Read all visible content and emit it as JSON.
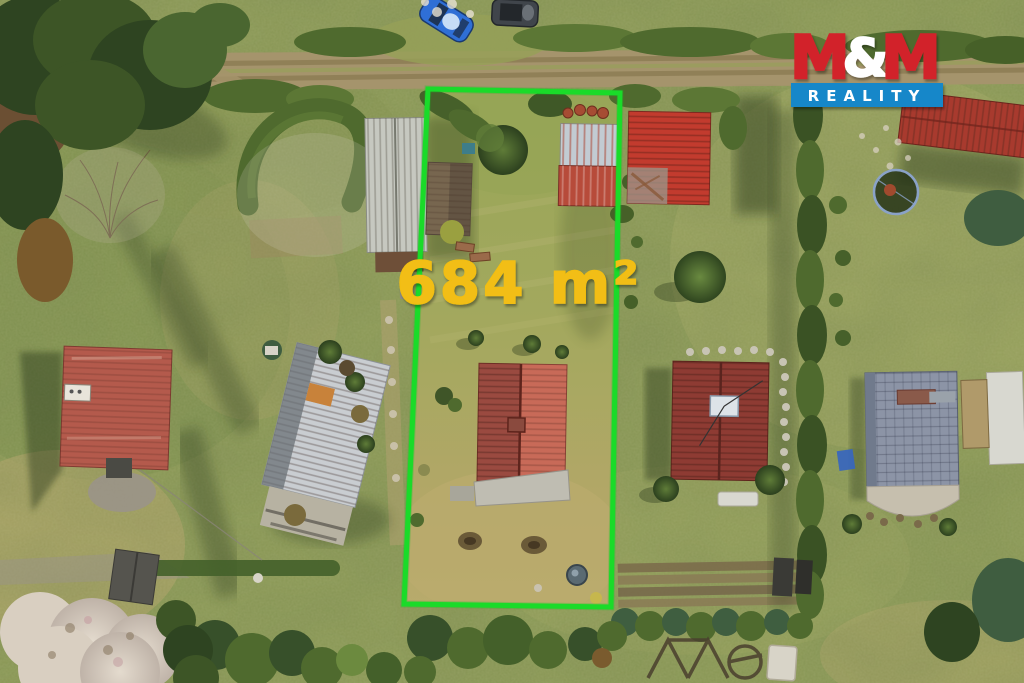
{
  "overlay": {
    "area_label": "684 m²",
    "area_label_color": "#F2BE12",
    "boundary_color": "#1EE42C",
    "boundary_points": "428,89 620,93 611,607 404,604",
    "boundary_stroke_width": "5"
  },
  "logo": {
    "m1": "M",
    "amp": "&",
    "m2": "M",
    "reality": "REALITY",
    "red": "#D2222A",
    "blue": "#1687C9",
    "white": "#FFFFFF"
  },
  "scene": {
    "colors": {
      "grass_base": "#8C9A56",
      "grass_dry": "#B6A76B",
      "road": "#A5946C",
      "hedge": "#4F6A2E",
      "conifer": "#2E4421",
      "roof_left_red": "#B45A4C",
      "roof_center_white": "#C9CDD1",
      "roof_plot_dark": "#9A4A40",
      "roof_plot_light": "#C86A58",
      "roof_right_maroon": "#8E3B33",
      "roof_far_slate": "#8C94A6",
      "roof_topright_red": "#C23B2E",
      "roof_longred": "#A83A2E",
      "barn_gray": "#C6C8C0",
      "shed_brown": "#77664F",
      "shed_top_white": "#C2CBD2",
      "shed_bottom_red": "#B74B3A",
      "patio_concrete": "#BFBDB2",
      "car_blue": "#2F6FD6",
      "car_dark": "#40454B",
      "blossom": "#D9CFC1"
    }
  }
}
